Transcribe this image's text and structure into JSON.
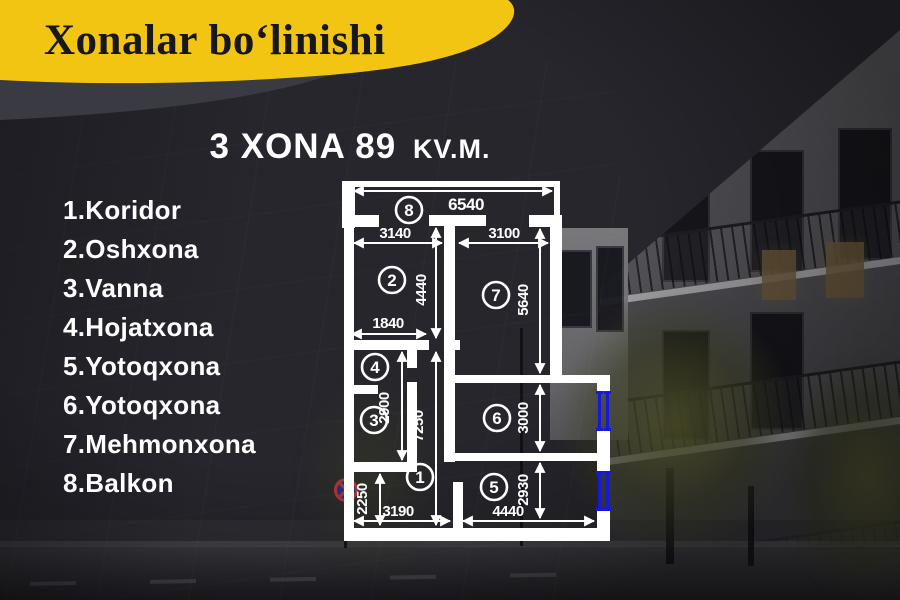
{
  "banner": {
    "title": "Xonalar boʻlinishi"
  },
  "heading": {
    "main": "3 XONA 89",
    "unit": "KV.M."
  },
  "room_list": {
    "items": [
      "1.Koridor",
      "2.Oshxona",
      "3.Vanna",
      "4.Hojatxona",
      "5.Yotoqxona",
      "6.Yotoqxona",
      "7.Mehmonxona",
      "8.Balkon"
    ]
  },
  "plan": {
    "numbers": {
      "n1": "1",
      "n2": "2",
      "n3": "3",
      "n4": "4",
      "n5": "5",
      "n6": "6",
      "n7": "7",
      "n8": "8"
    },
    "dims": {
      "balcony_width": "6540",
      "kitchen_width": "3140",
      "living_width": "3100",
      "kitchen_height": "4440",
      "living_height": "5640",
      "niche_width": "1840",
      "bath_height": "2900",
      "corridor_height": "7250",
      "bedroom6_height": "3000",
      "entry_height": "2250",
      "hall_width": "3190",
      "bedroom5_width": "4440",
      "bedroom5_height": "2930"
    }
  },
  "colors": {
    "accent_yellow": "#f3c513",
    "background_dark": "#27262d",
    "wall_white": "#ffffff",
    "window_blue": "#1818da",
    "text_white": "#ffffff"
  }
}
